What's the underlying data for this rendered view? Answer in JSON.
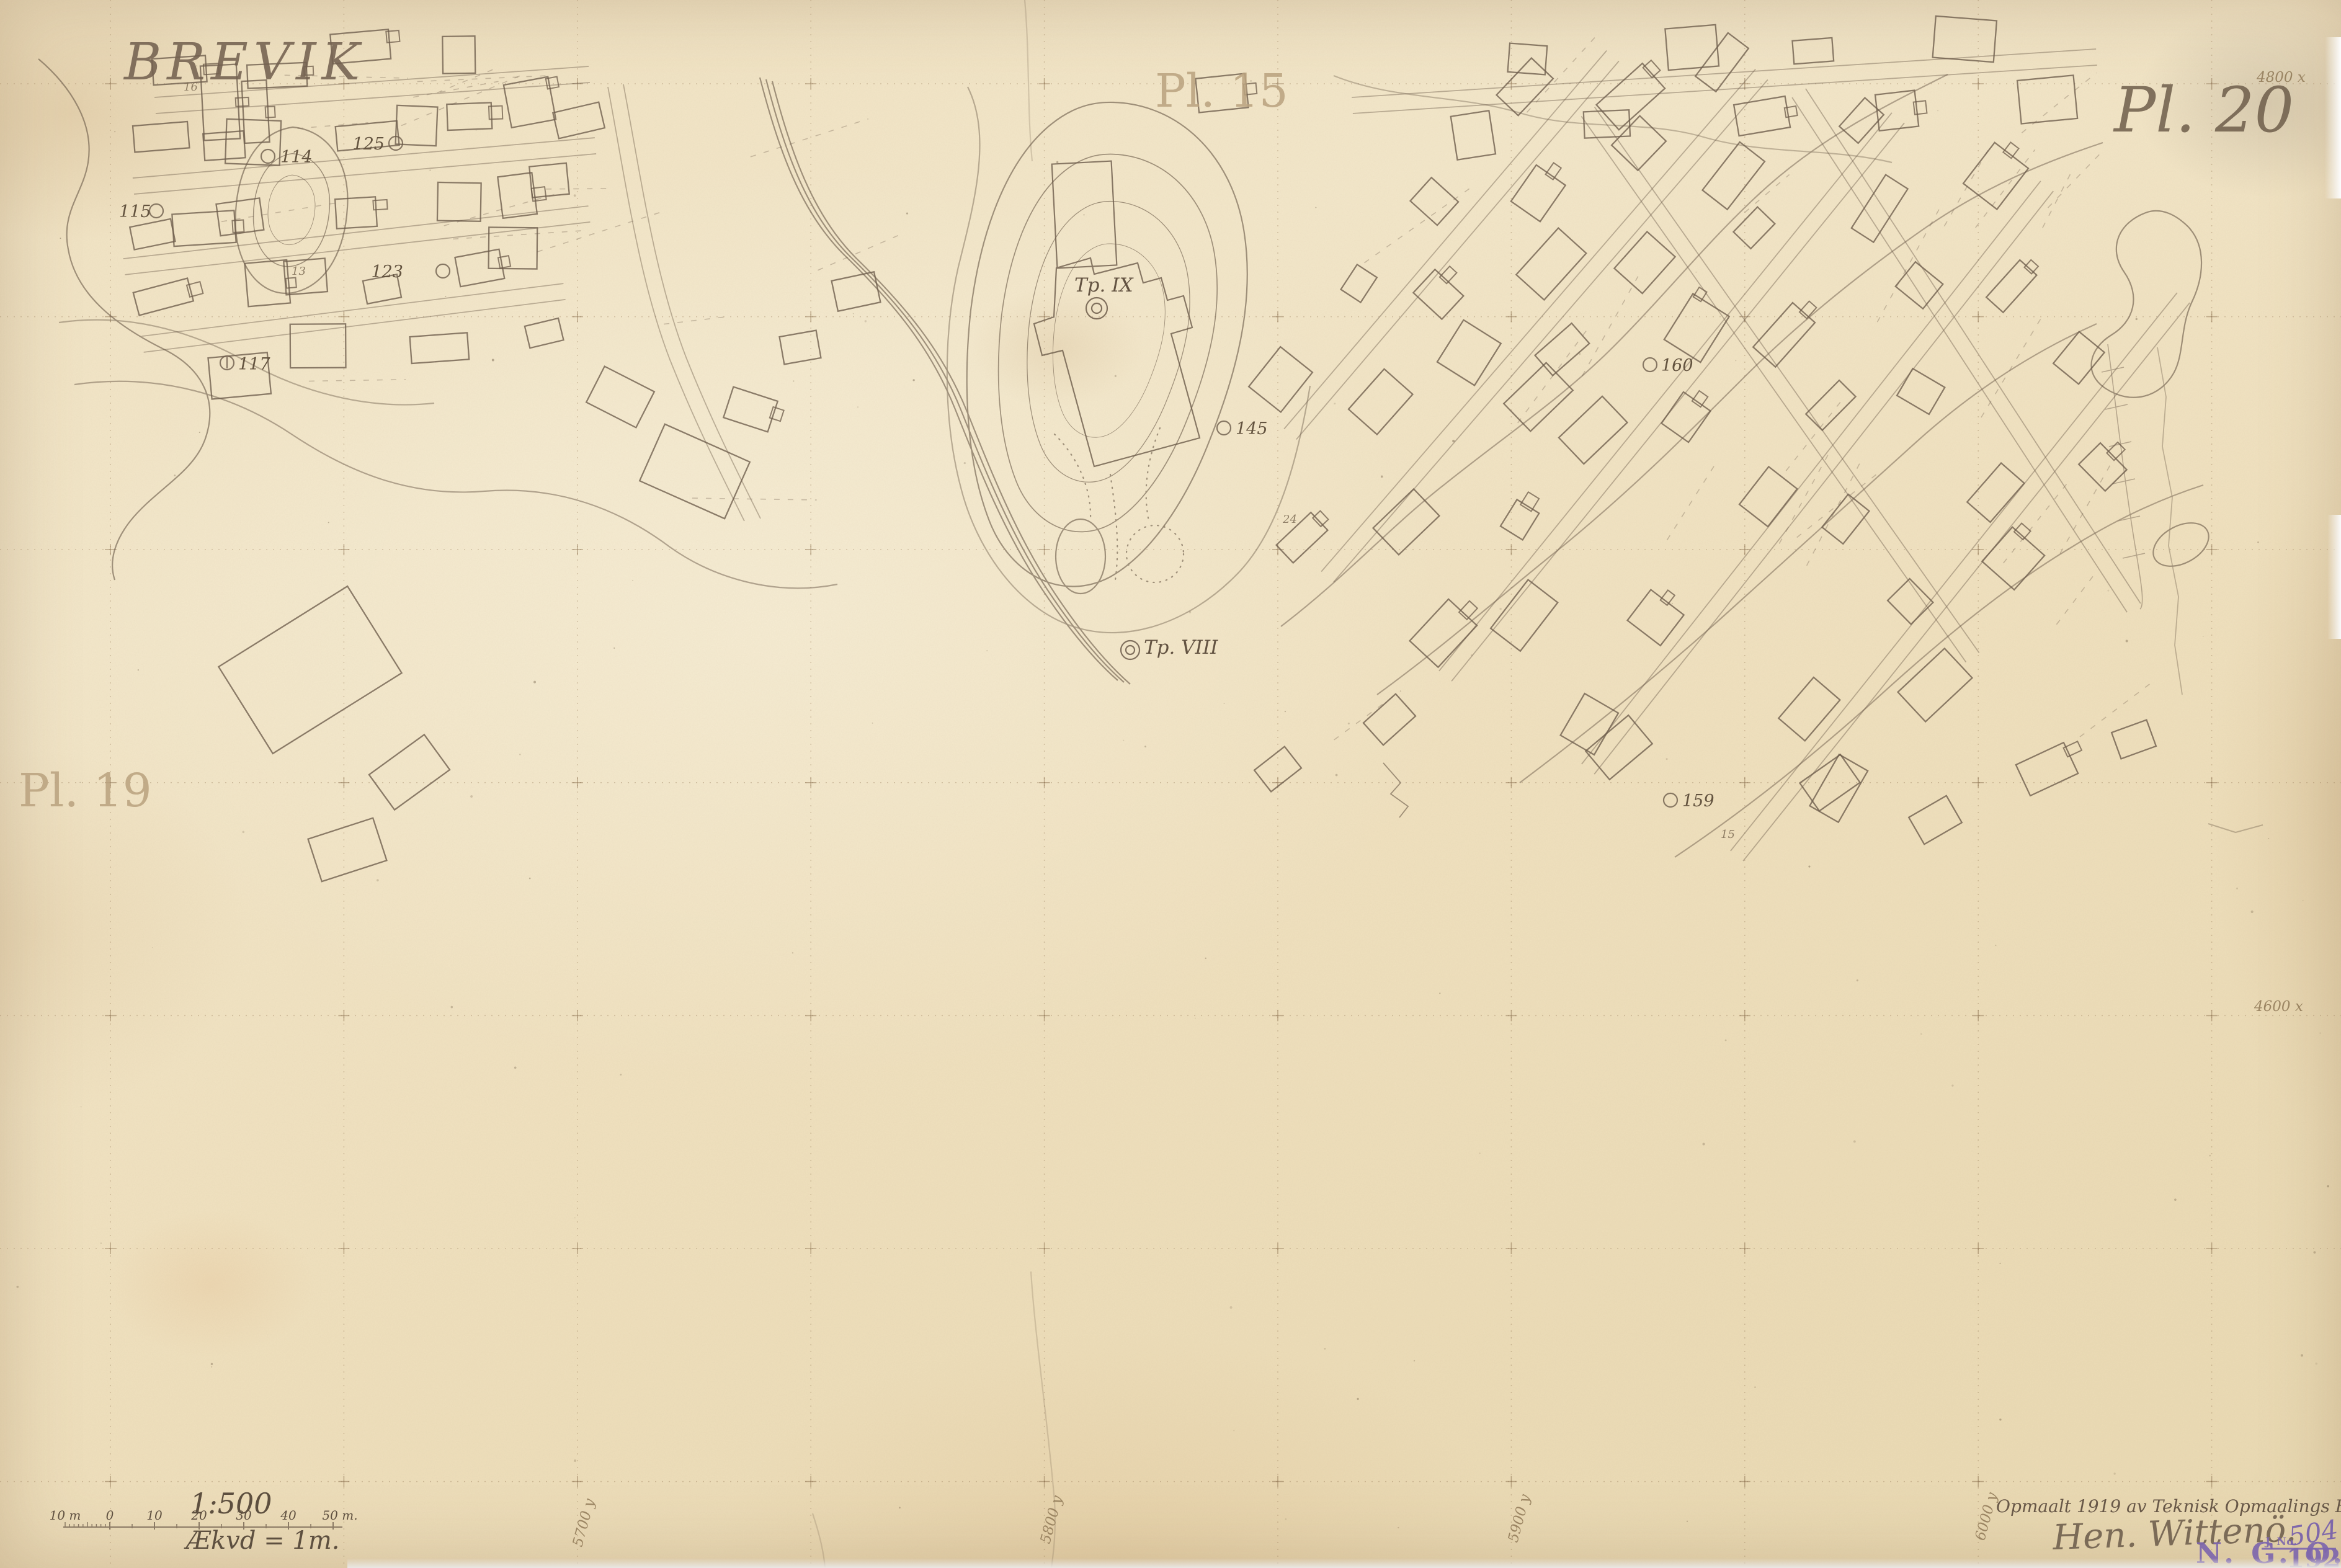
{
  "title": "BREVIK",
  "plates": {
    "top_center": "Pl. 15",
    "top_right": "Pl. 20",
    "left": "Pl. 19"
  },
  "grid": {
    "x_labels": [
      "4800 x",
      "4600 x"
    ],
    "y_labels": [
      "5700 y",
      "5800 y",
      "5900 y",
      "6000 y"
    ]
  },
  "map": {
    "triangulation_points": [
      {
        "text": "Tp. IX"
      },
      {
        "text": "Tp. VIII"
      }
    ],
    "point_labels": [
      {
        "text": "114"
      },
      {
        "text": "115"
      },
      {
        "text": "117"
      },
      {
        "text": "123"
      },
      {
        "text": "125"
      },
      {
        "text": "145"
      },
      {
        "text": "159"
      },
      {
        "text": "160"
      }
    ],
    "contour_labels": [
      {
        "text": "16"
      },
      {
        "text": "13"
      },
      {
        "text": "15"
      },
      {
        "text": "24"
      }
    ]
  },
  "scale": {
    "ratio": "1:500",
    "equidistance": "Ækvd = 1m.",
    "bar_labels": [
      "10 m",
      "0",
      "10",
      "20",
      "30",
      "40",
      "50 m."
    ]
  },
  "credits": {
    "surveyed": "Opmaalt 1919 av Teknisk Opmaalings Byraa",
    "signature": "Hen. Wittenö.",
    "stamp": {
      "org": "N. G. O.",
      "journal": "J. No.",
      "number": "504",
      "year": "1921"
    }
  },
  "colors": {
    "paper": "#f1e3c3",
    "pencil": "#6d5c4b",
    "stamp": "#7d66ad"
  }
}
